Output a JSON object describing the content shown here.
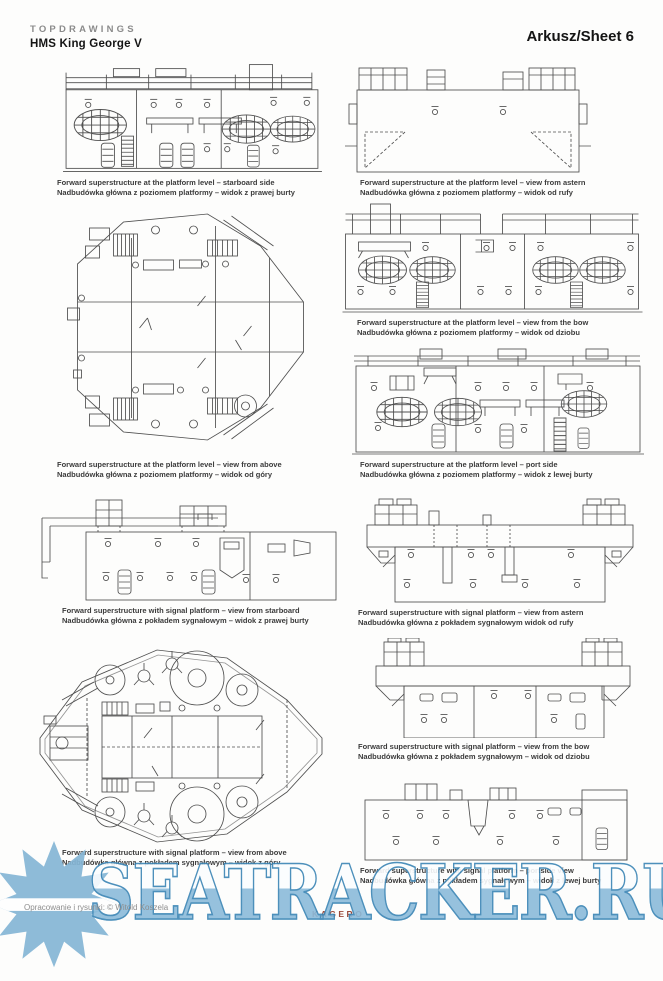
{
  "header": {
    "brand": "TOPDRAWINGS",
    "ship": "HMS King George V",
    "sheet": "Arkusz/Sheet 6"
  },
  "figures": [
    {
      "id": "platform-starboard",
      "caption_en": "Forward superstructure at the platform level – starboard side",
      "caption_pl": "Nadbudówka główna z poziomem platformy – widok z prawej burty"
    },
    {
      "id": "platform-astern",
      "caption_en": "Forward superstructure at the platform level – view from astern",
      "caption_pl": "Nadbudówka główna z poziomem platformy – widok od rufy"
    },
    {
      "id": "platform-bow",
      "caption_en": "Forward superstructure at the platform level – view from the bow",
      "caption_pl": "Nadbudówka główna z poziomem platformy – widok od dziobu"
    },
    {
      "id": "platform-above",
      "caption_en": "Forward superstructure at the platform level – view from above",
      "caption_pl": "Nadbudówka główna z poziomem platformy – widok od góry"
    },
    {
      "id": "platform-port",
      "caption_en": "Forward superstructure at the platform level – port side",
      "caption_pl": "Nadbudówka główna z poziomem platformy – widok z lewej burty"
    },
    {
      "id": "signal-starboard",
      "caption_en": "Forward superstructure with signal platform – view from starboard",
      "caption_pl": "Nadbudówka główna z pokładem sygnałowym – widok z prawej burty"
    },
    {
      "id": "signal-astern",
      "caption_en": "Forward superstructure with signal platform – view from astern",
      "caption_pl": "Nadbudówka główna z pokładem sygnałowym widok od rufy"
    },
    {
      "id": "signal-bow",
      "caption_en": "Forward superstructure with signal platform – view from the bow",
      "caption_pl": "Nadbudówka główna z pokładem sygnałowym – widok od dziobu"
    },
    {
      "id": "signal-above",
      "caption_en": "Forward superstructure with signal platform – view from above",
      "caption_pl": "Nadbudówka główna z pokładem sygnałowym – widok z góry"
    },
    {
      "id": "signal-port",
      "caption_en": "Forward superstructure with signal platform – portside view",
      "caption_pl": "Nadbudówka główna z pokładem sygnałowym – widok z lewej burty"
    }
  ],
  "footer": {
    "credit": "Opracowanie i rysunki: © Witold Koszela",
    "publisher": "KAGERO"
  },
  "watermark": {
    "text": "SEATRACKER.RU",
    "logo": "sun-logo",
    "fill_color": "#8bbbda",
    "outline_color": "#3b85b5",
    "publisher_color": "#9a4a3a"
  }
}
